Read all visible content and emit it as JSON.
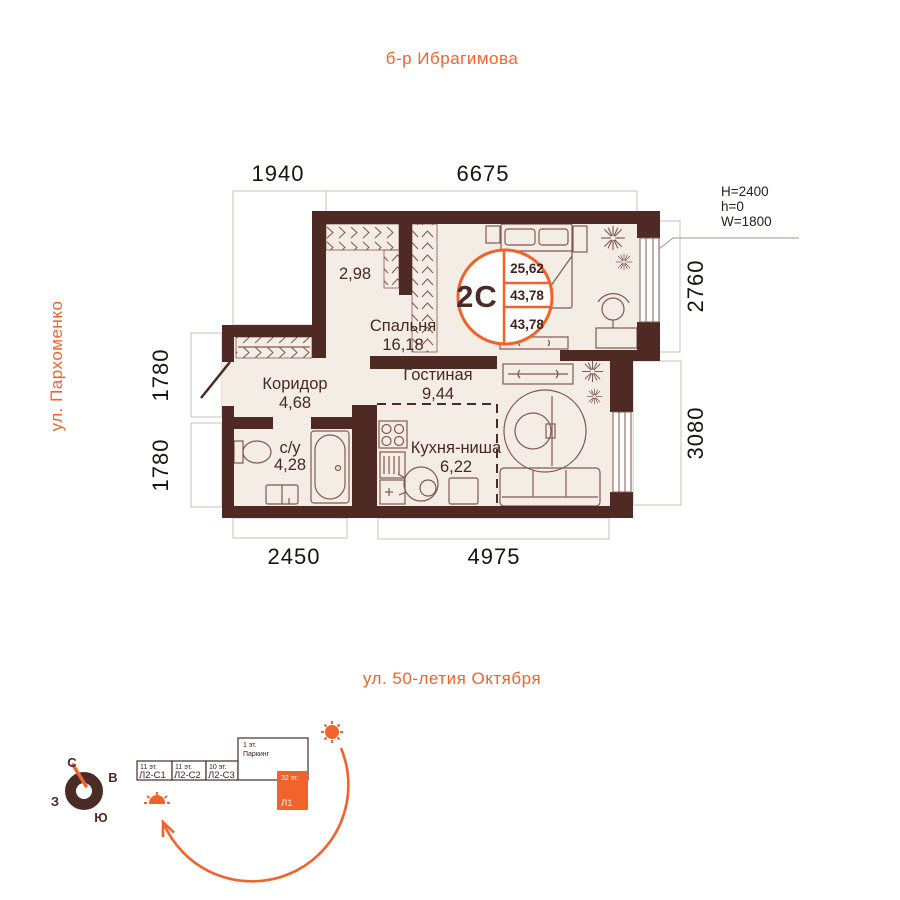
{
  "streets": {
    "top": "б-р Ибрагимова",
    "left": "ул. Пархоменко",
    "bottom": "ул. 50-летия Октября"
  },
  "dimensions": {
    "top_left": "1940",
    "top_main": "6675",
    "right_upper": "2760",
    "right_lower": "3080",
    "left_upper": "1780",
    "left_lower": "1780",
    "bottom_left": "2450",
    "bottom_right": "4975"
  },
  "window_specs": {
    "line1": "H=2400",
    "line2": "h=0",
    "line3": "W=1800"
  },
  "unit_badge": {
    "type": "2С",
    "rows": [
      "25,62",
      "43,78",
      "43,78"
    ]
  },
  "rooms": {
    "bedroom": {
      "name": "Спальня",
      "area": "16,18"
    },
    "wardrobe": {
      "area": "2,98"
    },
    "corridor": {
      "name": "Коридор",
      "area": "4,68"
    },
    "bathroom": {
      "name": "с/у",
      "area": "4,28"
    },
    "kitchen": {
      "name": "Кухня-ниша",
      "area": "6,22"
    },
    "living": {
      "name": "Гостиная",
      "area": "9,44"
    }
  },
  "compass": {
    "north": "С",
    "east": "В",
    "south": "Ю",
    "west": "З"
  },
  "site_plan": {
    "blocks": [
      {
        "floors": "11 эт.",
        "label": "Л2-С1"
      },
      {
        "floors": "11 эт.",
        "label": "Л2-С2"
      },
      {
        "floors": "10 эт.",
        "label": "Л2-С3"
      },
      {
        "floors": "1 эт.",
        "label": "Паркинг"
      },
      {
        "floors": "32 эт.",
        "label": "Л1"
      }
    ]
  },
  "colors": {
    "accent": "#F2632B",
    "wall": "#4F2A25",
    "floor": "#F3EDE5"
  }
}
